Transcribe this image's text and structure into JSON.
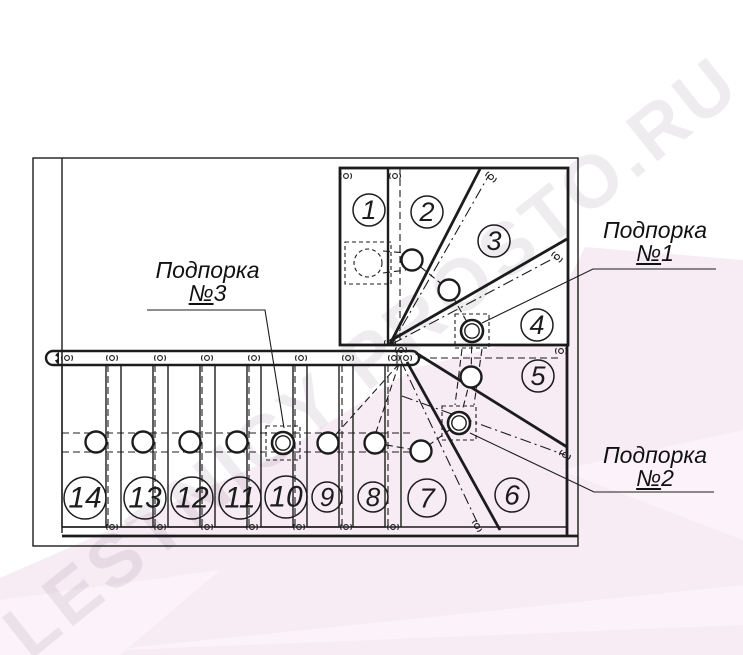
{
  "watermark": {
    "text": "LESTNICY PROSTO.RU"
  },
  "steps": [
    "1",
    "2",
    "3",
    "4",
    "5",
    "6",
    "7",
    "8",
    "9",
    "10",
    "11",
    "12",
    "13",
    "14"
  ],
  "supports": [
    {
      "name": "Подпорка",
      "no": "№",
      "digit": "1"
    },
    {
      "name": "Подпорка",
      "no": "№",
      "digit": "2"
    },
    {
      "name": "Подпорка",
      "no": "№",
      "digit": "3"
    }
  ],
  "colors": {
    "line": "#1c1c1c",
    "pink": "#f7ebf4",
    "pink_light": "#fbf3f9",
    "watermark": "rgba(125,108,128,0.13)"
  }
}
